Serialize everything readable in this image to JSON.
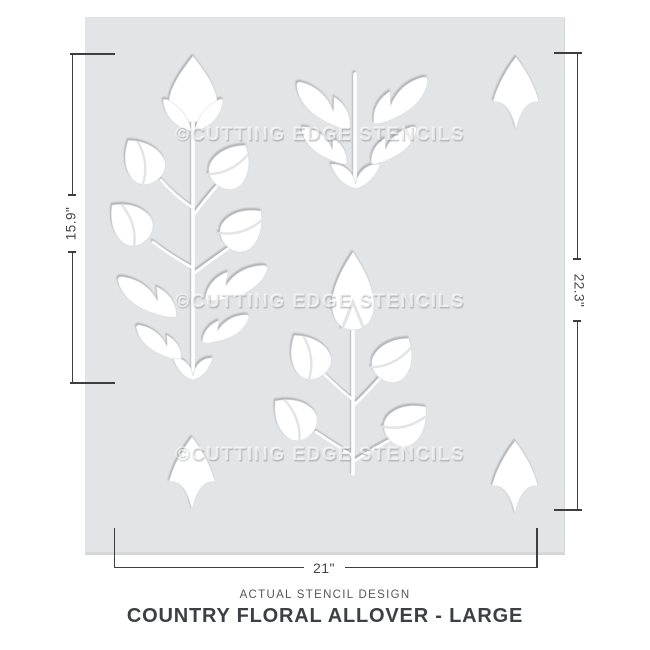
{
  "stencil": {
    "watermark": "©CUTTING EDGE STENCILS",
    "watermark_count": 3,
    "sheet_color": "#e3e4e6",
    "cutout_color": "#ffffff",
    "motifs": [
      "large-flower-stem-left",
      "leafy-branch-top-center",
      "small-flower-stem-center",
      "corner-petal-top-right",
      "corner-petal-bottom-left",
      "corner-petal-bottom-right"
    ]
  },
  "dimensions": {
    "left": "15.9\"",
    "right": "22.3\"",
    "bottom": "21\""
  },
  "title_block": {
    "subtitle": "ACTUAL STENCIL DESIGN",
    "title": "COUNTRY FLORAL ALLOVER - LARGE"
  },
  "colors": {
    "dimension_line": "#3e3e3e",
    "dimension_text": "#474747",
    "subtitle_text": "#54575a",
    "title_text": "#3c4045",
    "watermark_text": "#ffffff"
  }
}
